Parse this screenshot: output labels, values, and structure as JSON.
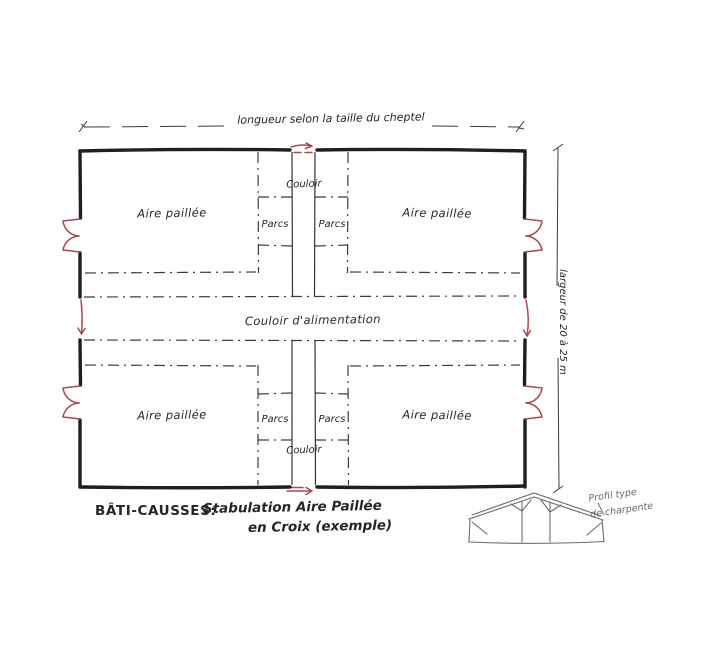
{
  "page": {
    "background": "#ffffff",
    "type": "hand-drawn architectural plan sketch"
  },
  "colors": {
    "ink": "#1f1f1f",
    "partition_dash": "#3c3c3c",
    "red_accent": "#a9474f",
    "truss_gray": "#6b6b6b"
  },
  "icons": {
    "double_door": "double-swing-door symbol (two quarter-arc leaves) drawn in red",
    "flow_arrow": "red circulation arrow at each corridor opening"
  },
  "dimensions": {
    "top_label": "longueur selon la taille du cheptel",
    "right_label": "largeur de 20 à 25 m"
  },
  "plan": {
    "aire_labels": [
      "Aire paillée",
      "Aire paillée",
      "Aire paillée",
      "Aire paillée"
    ],
    "parc_labels": [
      "Parcs",
      "Parcs",
      "Parcs",
      "Parcs"
    ],
    "couloir_top": "Couloir",
    "couloir_bottom": "Couloir",
    "couloir_alimentation": "Couloir d'alimentation"
  },
  "title": {
    "prefix": "BÂTI-CAUSSES:",
    "line1": "Stabulation Aire Paillée",
    "line2": "en Croix (exemple)"
  },
  "truss": {
    "label_line1": "Profil type",
    "label_line2": "de charpente"
  }
}
